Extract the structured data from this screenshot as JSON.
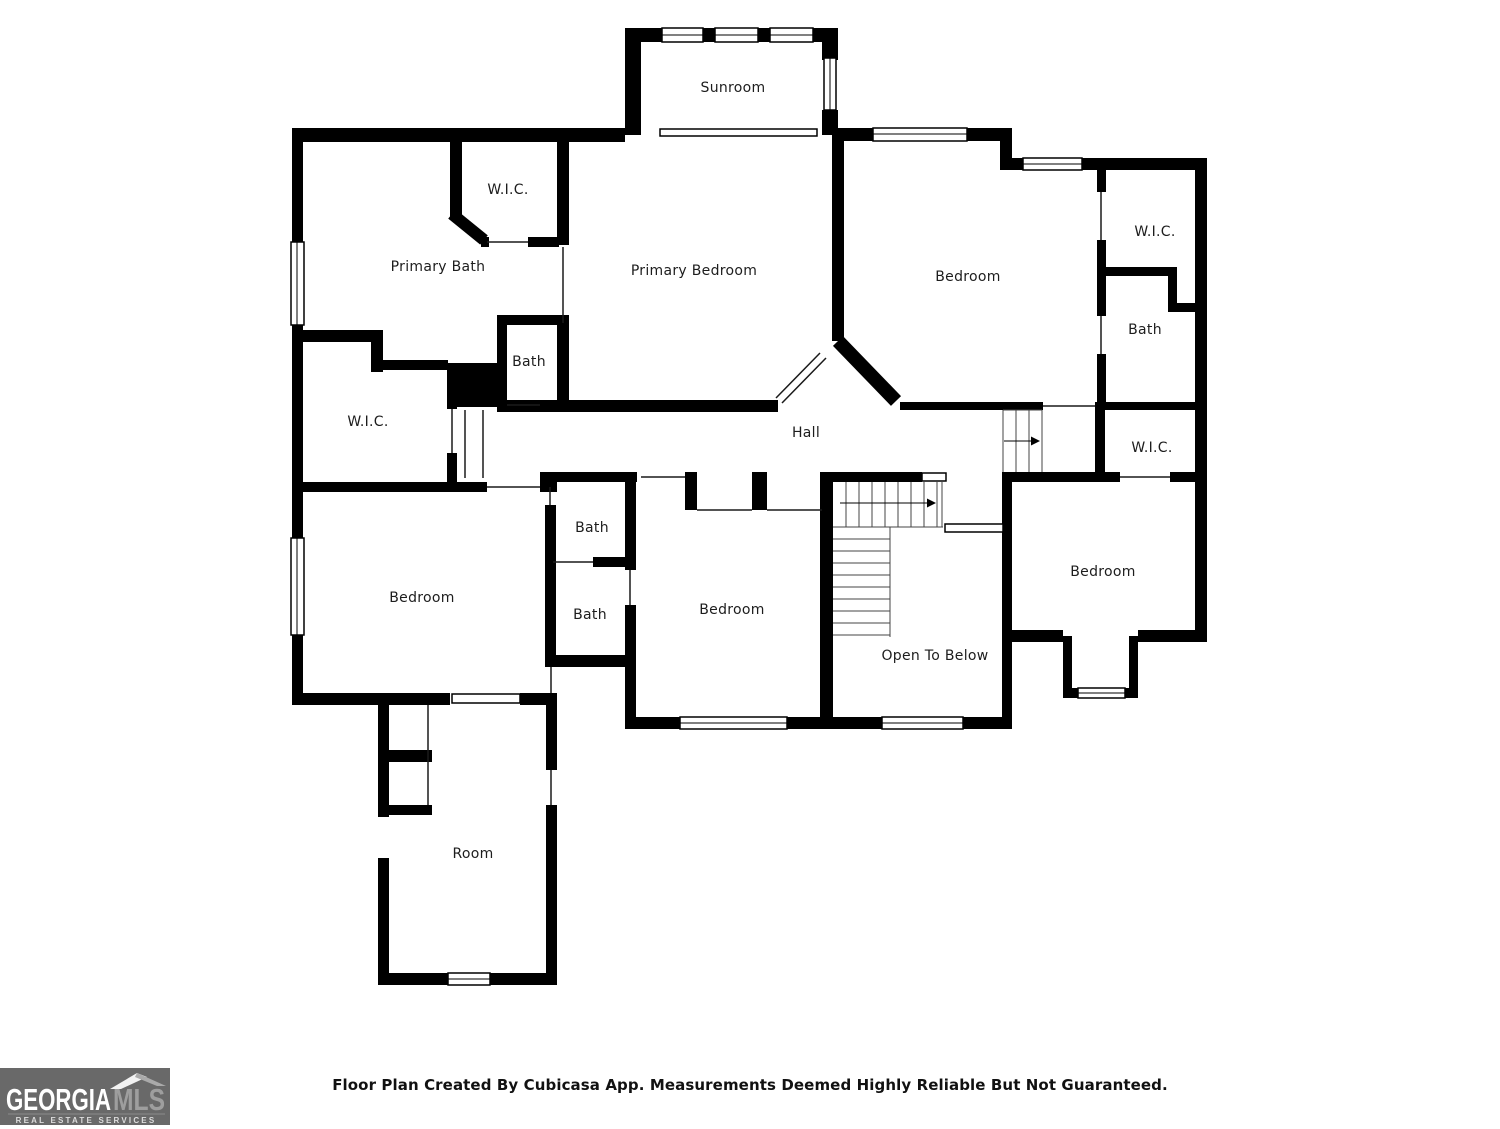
{
  "floor_plan": {
    "labels": {
      "sunroom": "Sunroom",
      "wic_primary": "W.I.C.",
      "primary_bath": "Primary Bath",
      "primary_bedroom": "Primary Bedroom",
      "bedroom_top_right": "Bedroom",
      "wic_top_right": "W.I.C.",
      "bath_top_right": "Bath",
      "wic_left": "W.I.C.",
      "hall": "Hall",
      "bath_hall": "Bath",
      "bath_upper": "Bath",
      "wic_right": "W.I.C.",
      "bedroom_left": "Bedroom",
      "bath_lower": "Bath",
      "bedroom_middle": "Bedroom",
      "bedroom_right": "Bedroom",
      "open_to_below": "Open To Below",
      "room": "Room"
    },
    "colors": {
      "wall": "#000000",
      "floor": "#ffffff",
      "label_text": "#1d1d1d",
      "logo_background": "#696969"
    }
  },
  "footer": {
    "disclaimer": "Floor Plan Created By Cubicasa App. Measurements Deemed Highly Reliable But Not Guaranteed."
  },
  "logo": {
    "brand": "GEORGIA",
    "brand_suffix": "MLS",
    "tagline": "REAL ESTATE SERVICES"
  }
}
